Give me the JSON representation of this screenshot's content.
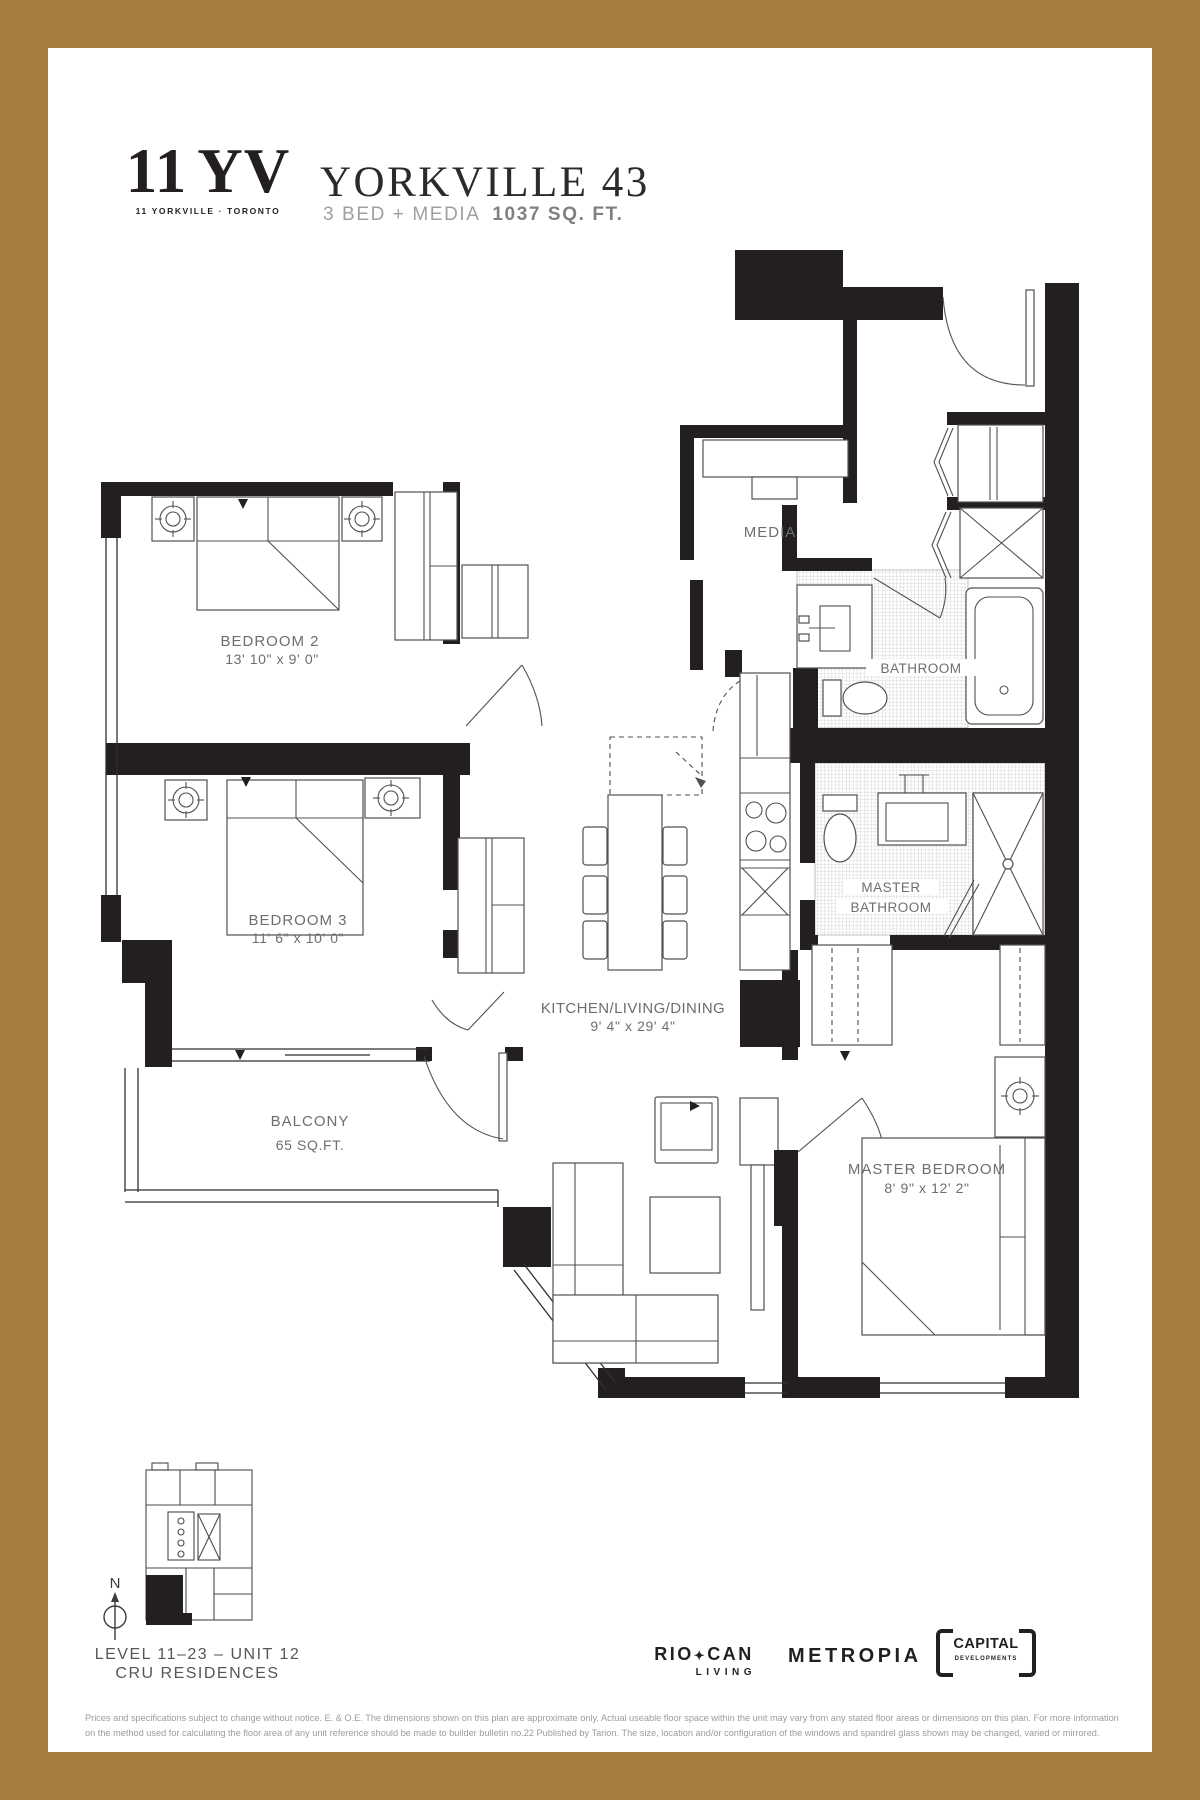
{
  "brand": {
    "logo_number": "11",
    "logo_letters": "YV",
    "tagline": "11 YORKVILLE · TORONTO"
  },
  "header": {
    "title": "YORKVILLE 43",
    "plan_type": "3 BED + MEDIA",
    "area": "1037 SQ. FT."
  },
  "plan": {
    "rooms": {
      "bedroom2": {
        "name": "BEDROOM 2",
        "dims": "13' 10\" x 9' 0\""
      },
      "bedroom3": {
        "name": "BEDROOM 3",
        "dims": "11' 6\" x 10' 0\""
      },
      "media": {
        "name": "MEDIA"
      },
      "bathroom": {
        "name": "BATHROOM"
      },
      "master_bathroom": {
        "line1": "MASTER",
        "line2": "BATHROOM"
      },
      "kitchen_living_dining": {
        "name": "KITCHEN/LIVING/DINING",
        "dims": "9' 4\" x 29' 4\""
      },
      "balcony": {
        "name": "BALCONY",
        "dims": "65 SQ.FT."
      },
      "master_bedroom": {
        "name": "MASTER BEDROOM",
        "dims": "8' 9\" x 12' 2\""
      }
    }
  },
  "keyplan": {
    "north": "N",
    "level": "LEVEL 11–23 – UNIT 12",
    "residence": "CRU RESIDENCES"
  },
  "footer": {
    "riocan_rio": "RIO",
    "riocan_leaf": "✦",
    "riocan_can": "CAN",
    "riocan_living": "LIVING",
    "metropia": "METROPIA",
    "capital_line1": "CAPITAL",
    "capital_line2": "DEVELOPMENTS",
    "disclaimer1": "Prices and specifications subject to change without notice. E. & O.E. The dimensions shown on this plan are approximate only. Actual useable floor space within the unit may vary from any stated floor areas or dimensions on this plan. For more information",
    "disclaimer2": "on the method used for calculating the floor area of any unit reference should be made to builder bulletin no.22 Published by Tarion. The size, location and/or configuration of the windows and spandrel glass shown may be changed, varied or mirrored."
  },
  "colors": {
    "border": "#A67D3C",
    "wall": "#231F20",
    "label": "#6D6E71",
    "disclaimer": "#9C9C9C"
  }
}
